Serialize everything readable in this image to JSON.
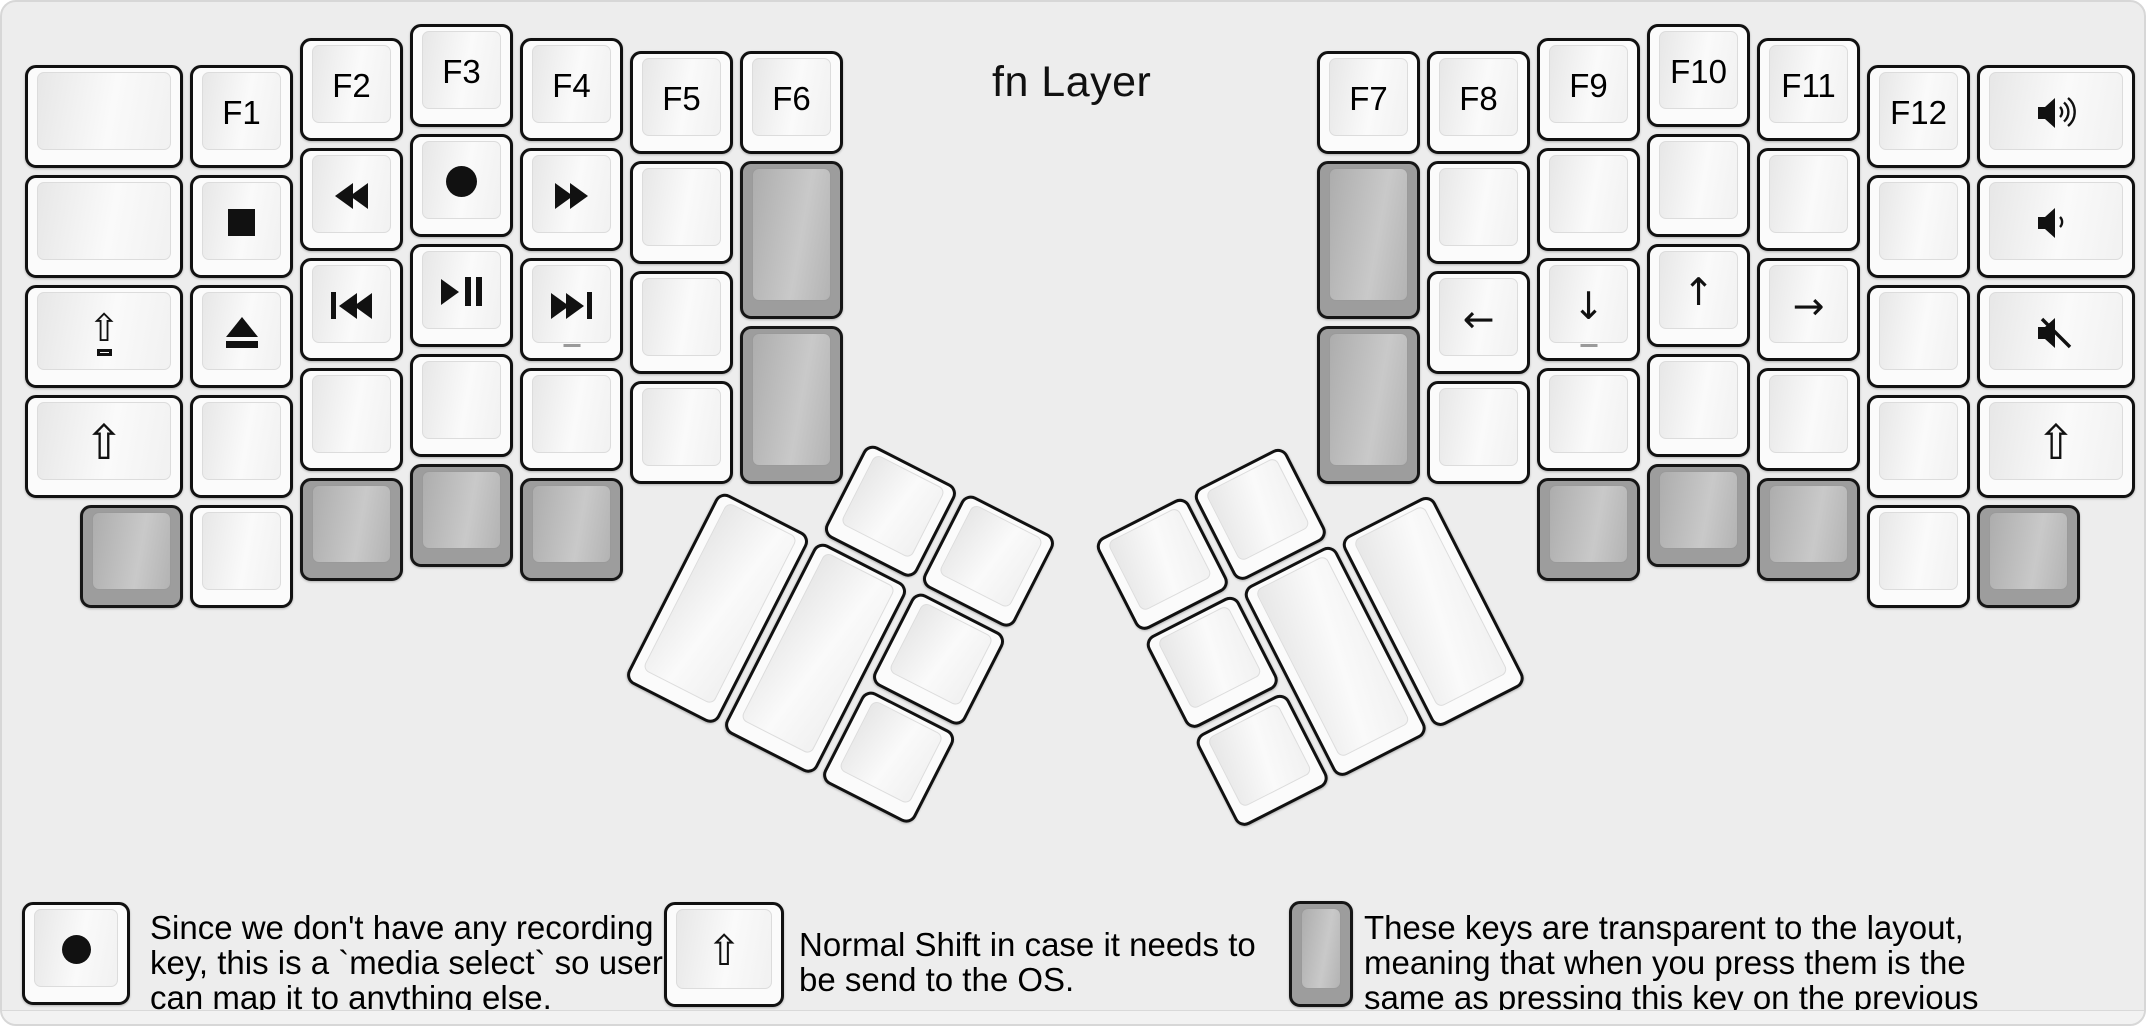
{
  "keyboard": {
    "title": "fn Layer",
    "colors": {
      "background": "#ededed",
      "key_white_rim": "#fbfbfb",
      "key_white_top": "#f1f1f1",
      "key_transparent_rim": "#9d9d9d",
      "key_transparent_top": "#bdbdbd",
      "key_outline": "#111111",
      "text": "#000000"
    },
    "left": {
      "columns": [
        {
          "name": "outer-column",
          "keys": [
            {
              "name": "key-blank",
              "blank": true
            },
            {
              "name": "key-blank",
              "blank": true
            },
            {
              "name": "key-caps-shift",
              "icon": "caps-shift-icon"
            },
            {
              "name": "key-shift",
              "icon": "shift-icon"
            }
          ]
        },
        {
          "name": "f1-column",
          "keys": [
            {
              "name": "key-f1",
              "label": "F1"
            },
            {
              "name": "key-stop",
              "icon": "stop-icon"
            },
            {
              "name": "key-eject",
              "icon": "eject-icon"
            },
            {
              "name": "key-blank",
              "blank": true
            }
          ]
        },
        {
          "name": "f2-column",
          "keys": [
            {
              "name": "key-f2",
              "label": "F2"
            },
            {
              "name": "key-rewind",
              "icon": "rewind-icon"
            },
            {
              "name": "key-prev-track",
              "icon": "prev-track-icon"
            },
            {
              "name": "key-blank",
              "blank": true
            }
          ]
        },
        {
          "name": "f3-column",
          "keys": [
            {
              "name": "key-f3",
              "label": "F3"
            },
            {
              "name": "key-record",
              "icon": "record-icon"
            },
            {
              "name": "key-play-pause",
              "icon": "play-pause-icon"
            },
            {
              "name": "key-blank",
              "blank": true
            }
          ]
        },
        {
          "name": "f4-column",
          "keys": [
            {
              "name": "key-f4",
              "label": "F4"
            },
            {
              "name": "key-fast-forward",
              "icon": "fast-forward-icon"
            },
            {
              "name": "key-next-track",
              "icon": "next-track-icon",
              "sub": "_"
            },
            {
              "name": "key-blank",
              "blank": true
            }
          ]
        },
        {
          "name": "f5-column",
          "keys": [
            {
              "name": "key-f5",
              "label": "F5"
            },
            {
              "name": "key-blank",
              "blank": true
            },
            {
              "name": "key-blank",
              "blank": true
            },
            {
              "name": "key-blank",
              "blank": true
            }
          ]
        },
        {
          "name": "f6-column",
          "keys": [
            {
              "name": "key-f6",
              "label": "F6"
            },
            {
              "name": "key-transparent",
              "transparent": true
            },
            {
              "name": "key-transparent",
              "transparent": true
            }
          ]
        }
      ],
      "bottom_row": [
        {
          "name": "key-transparent",
          "transparent": true
        },
        {
          "name": "key-blank",
          "blank": true
        },
        {
          "name": "key-transparent",
          "transparent": true
        },
        {
          "name": "key-transparent",
          "transparent": true
        },
        {
          "name": "key-transparent",
          "transparent": true
        }
      ],
      "thumb_keys": [
        {
          "name": "key-blank",
          "blank": true
        },
        {
          "name": "key-blank",
          "blank": true
        },
        {
          "name": "key-blank",
          "blank": true
        },
        {
          "name": "key-blank",
          "blank": true
        },
        {
          "name": "key-blank",
          "blank": true
        },
        {
          "name": "key-blank",
          "blank": true
        }
      ]
    },
    "right": {
      "columns": [
        {
          "name": "f7-column",
          "keys": [
            {
              "name": "key-f7",
              "label": "F7"
            },
            {
              "name": "key-transparent",
              "transparent": true
            },
            {
              "name": "key-transparent",
              "transparent": true
            }
          ]
        },
        {
          "name": "f8-column",
          "keys": [
            {
              "name": "key-f8",
              "label": "F8"
            },
            {
              "name": "key-blank",
              "blank": true
            },
            {
              "name": "key-arrow-left",
              "icon": "left-arrow-icon"
            },
            {
              "name": "key-blank",
              "blank": true
            }
          ]
        },
        {
          "name": "f9-column",
          "keys": [
            {
              "name": "key-f9",
              "label": "F9"
            },
            {
              "name": "key-blank",
              "blank": true
            },
            {
              "name": "key-arrow-down",
              "icon": "down-arrow-icon",
              "sub": "_"
            },
            {
              "name": "key-blank",
              "blank": true
            }
          ]
        },
        {
          "name": "f10-column",
          "keys": [
            {
              "name": "key-f10",
              "label": "F10"
            },
            {
              "name": "key-blank",
              "blank": true
            },
            {
              "name": "key-arrow-up",
              "icon": "up-arrow-icon"
            },
            {
              "name": "key-blank",
              "blank": true
            }
          ]
        },
        {
          "name": "f11-column",
          "keys": [
            {
              "name": "key-f11",
              "label": "F11"
            },
            {
              "name": "key-blank",
              "blank": true
            },
            {
              "name": "key-arrow-right",
              "icon": "right-arrow-icon"
            },
            {
              "name": "key-blank",
              "blank": true
            }
          ]
        },
        {
          "name": "f12-column",
          "keys": [
            {
              "name": "key-f12",
              "label": "F12"
            },
            {
              "name": "key-blank",
              "blank": true
            },
            {
              "name": "key-blank",
              "blank": true
            },
            {
              "name": "key-blank",
              "blank": true
            }
          ]
        },
        {
          "name": "outer-column",
          "keys": [
            {
              "name": "key-volume-up",
              "icon": "volume-up-icon"
            },
            {
              "name": "key-volume-down",
              "icon": "volume-down-icon"
            },
            {
              "name": "key-mute",
              "icon": "mute-icon"
            },
            {
              "name": "key-shift",
              "icon": "shift-icon"
            }
          ]
        }
      ],
      "bottom_row": [
        {
          "name": "key-transparent",
          "transparent": true
        },
        {
          "name": "key-transparent",
          "transparent": true
        },
        {
          "name": "key-transparent",
          "transparent": true
        },
        {
          "name": "key-blank",
          "blank": true
        },
        {
          "name": "key-transparent",
          "transparent": true
        }
      ],
      "thumb_keys": [
        {
          "name": "key-blank",
          "blank": true
        },
        {
          "name": "key-blank",
          "blank": true
        },
        {
          "name": "key-blank",
          "blank": true
        },
        {
          "name": "key-blank",
          "blank": true
        },
        {
          "name": "key-blank",
          "blank": true
        },
        {
          "name": "key-blank",
          "blank": true
        }
      ]
    }
  },
  "legend": {
    "items": [
      {
        "key_icon": "record-icon",
        "key_style": "white",
        "text": "Since we don't have any recording key, this is a `media select` so user can map it to anything else."
      },
      {
        "key_icon": "shift-icon",
        "key_style": "white",
        "text": "Normal Shift in case it needs to be send to the OS."
      },
      {
        "key_icon": "none",
        "key_style": "transparent",
        "text": "These keys are transparent to the layout, meaning that when you press them is the same as pressing this key on the previous layer."
      }
    ]
  }
}
